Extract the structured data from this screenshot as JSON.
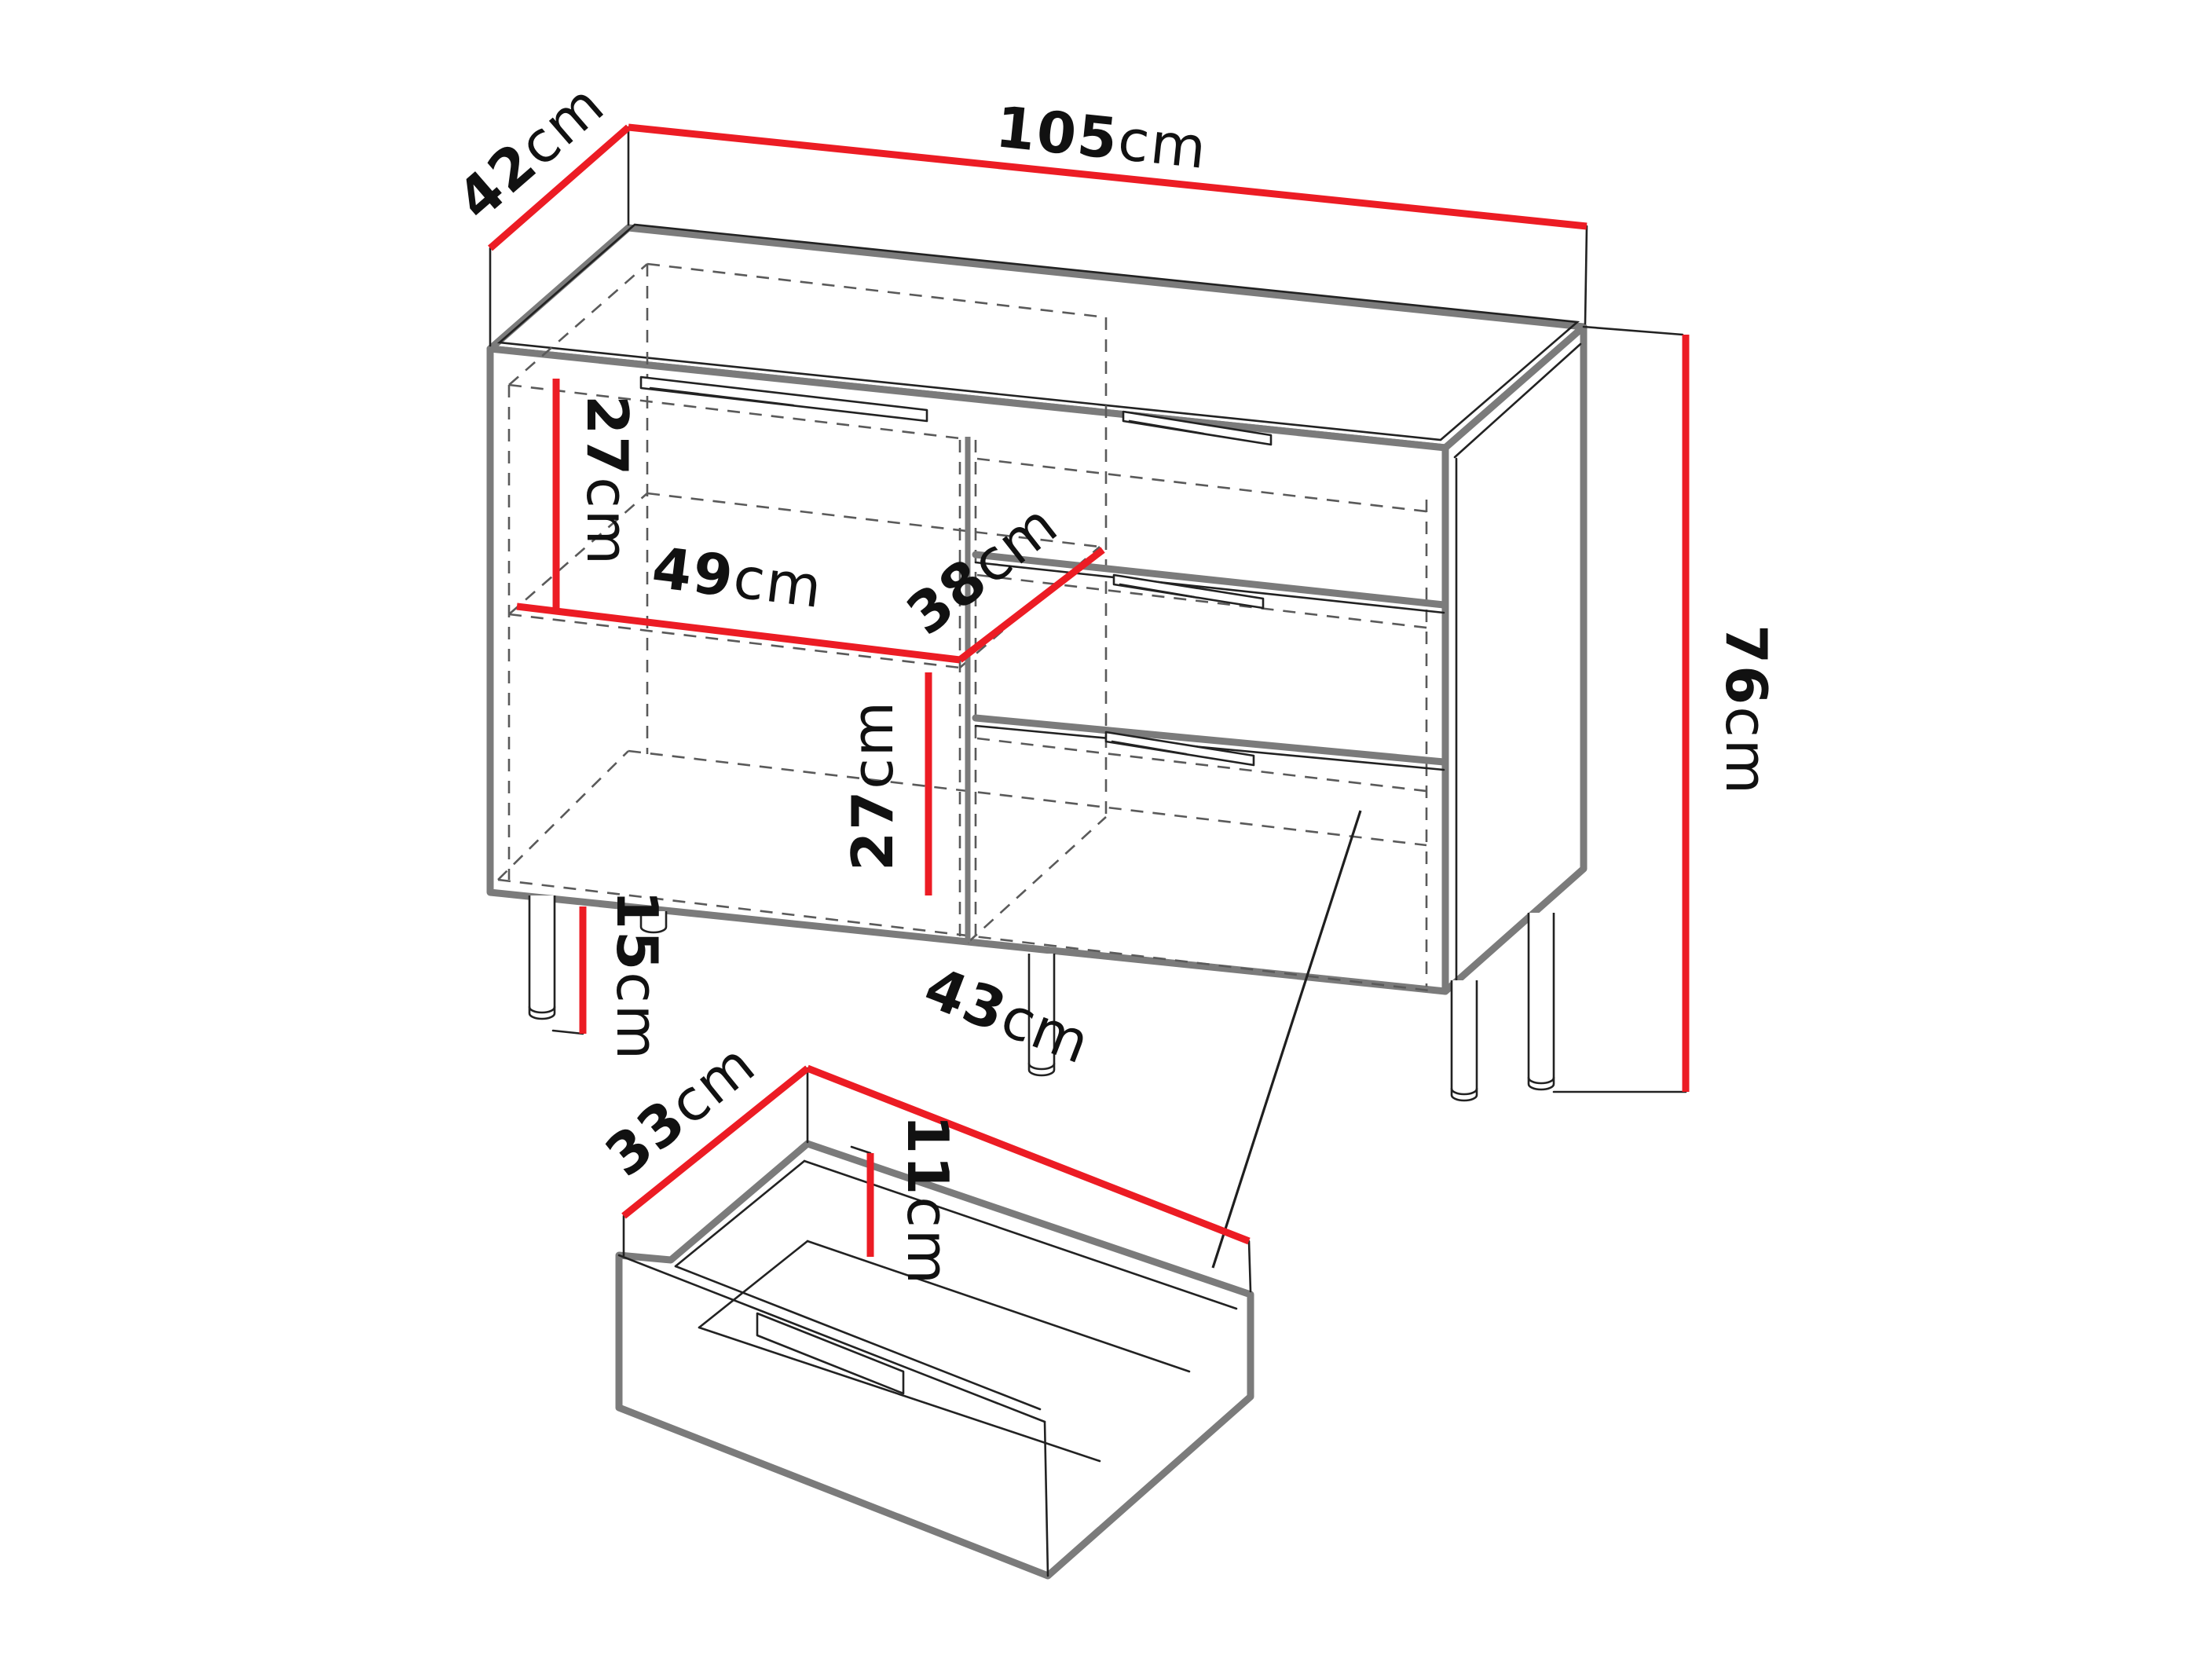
{
  "diagram": {
    "type": "furniture-dimension-drawing",
    "subject": "sideboard cabinet with shelf compartment, three drawers and a detail view of a single drawer"
  },
  "colors": {
    "dimension_line": "#ec1c24",
    "outline_thick": "#7b7b7b",
    "outline_thin": "#222222",
    "hidden_dashed": "#5a5a5a",
    "label_text": "#111111",
    "background": "#ffffff"
  },
  "dimensions": {
    "width": {
      "value": "105",
      "unit": "cm"
    },
    "depth": {
      "value": "42",
      "unit": "cm"
    },
    "height": {
      "value": "76",
      "unit": "cm"
    },
    "upper_inner": {
      "value": "27",
      "unit": "cm"
    },
    "shelf_width": {
      "value": "49",
      "unit": "cm"
    },
    "shelf_depth": {
      "value": "38",
      "unit": "cm"
    },
    "lower_inner": {
      "value": "27",
      "unit": "cm"
    },
    "leg_height": {
      "value": "15",
      "unit": "cm"
    },
    "drawer_depth": {
      "value": "33",
      "unit": "cm"
    },
    "drawer_width": {
      "value": "43",
      "unit": "cm"
    },
    "drawer_inner_height": {
      "value": "11",
      "unit": "cm"
    }
  }
}
